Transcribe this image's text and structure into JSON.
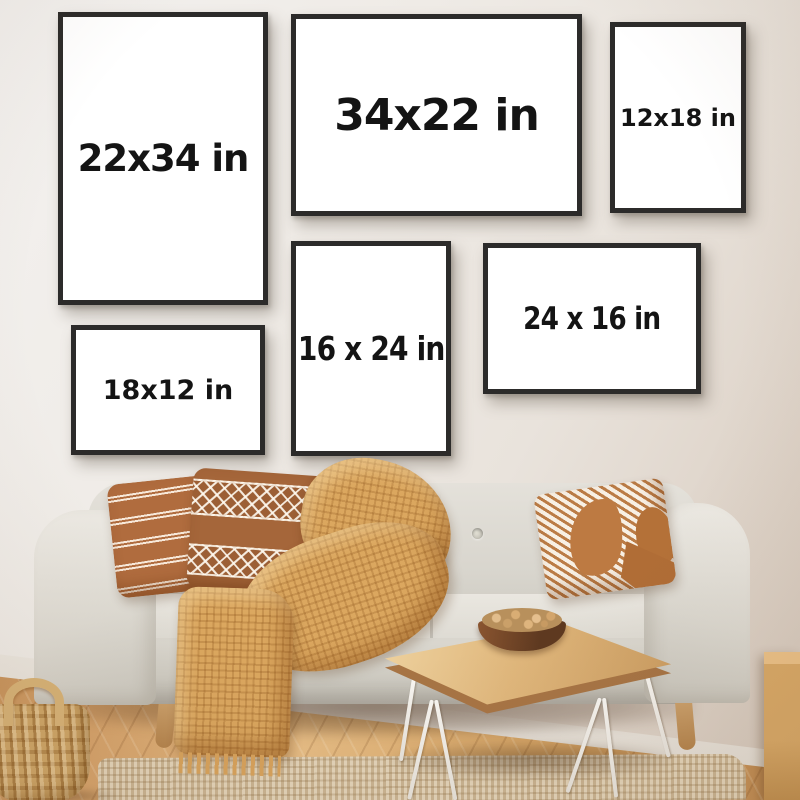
{
  "frames": [
    {
      "name": "frame-22x34",
      "label": "22x34 in",
      "orientation": "portrait"
    },
    {
      "name": "frame-34x22",
      "label": "34x22 in",
      "orientation": "landscape"
    },
    {
      "name": "frame-12x18",
      "label": "12x18 in",
      "orientation": "portrait"
    },
    {
      "name": "frame-16x24",
      "label": "16 x 24 in",
      "orientation": "portrait"
    },
    {
      "name": "frame-24x16",
      "label": "24 x 16 in",
      "orientation": "landscape"
    },
    {
      "name": "frame-18x12",
      "label": "18x12 in",
      "orientation": "landscape"
    }
  ],
  "colors": {
    "wall": "#efebe6",
    "frame_border": "#2c2b2a",
    "frame_mat": "#ffffff",
    "label_text": "#141414",
    "floor_wood": "#d5a169",
    "jute_rug": "#d6c2a2",
    "sofa_fabric": "#dcd9d1",
    "pillow_rust": "#b06c3e",
    "pillow_brown": "#a5663a",
    "blanket_mustard": "#dba75f",
    "table_wood": "#e0b77c",
    "hairpin_legs": "#f8f6f2",
    "bowl_walnut": "#6b4226",
    "basket_wicker": "#cfa667",
    "baseboard": "#f6f3ee"
  },
  "scene_objects": [
    "gallery-wall-frames",
    "gray-sofa",
    "striped-pillow",
    "diamond-pattern-pillow",
    "diagonal-stripe-pillow",
    "knit-blanket",
    "live-edge-coffee-table",
    "nut-bowl",
    "wicker-basket",
    "jute-rug",
    "herringbone-wood-floor",
    "wood-block-stool"
  ]
}
